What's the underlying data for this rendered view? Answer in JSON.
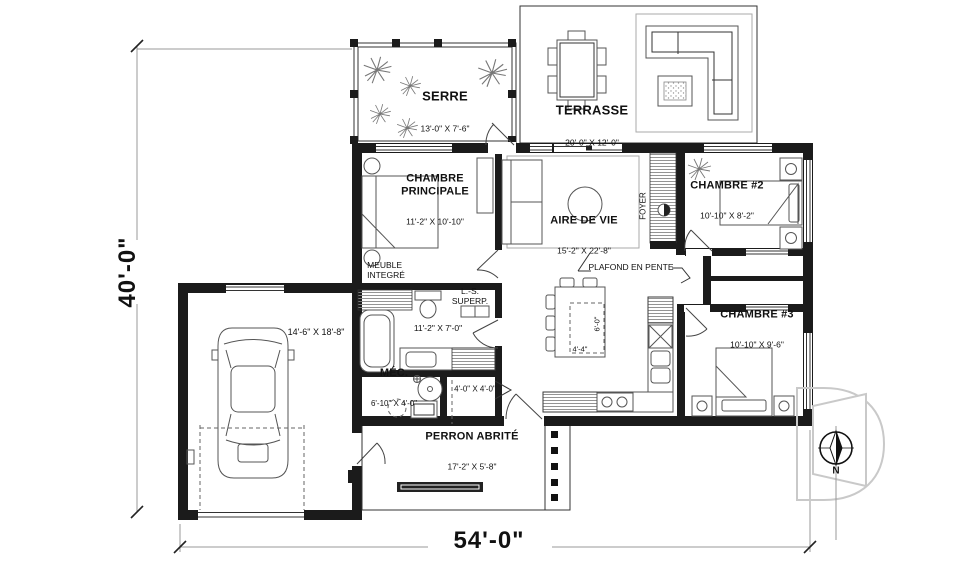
{
  "colors": {
    "walls": "#1b1b1b",
    "lines": "#555555",
    "dim": "#999999",
    "watermark": "#c9c9c9"
  },
  "dimensions": {
    "overall_width": "54'-0\"",
    "overall_height": "40'-0\""
  },
  "rooms": {
    "serre": {
      "name": "SERRE",
      "dims": "13'-0\" X 7'-6\""
    },
    "terrasse": {
      "name": "TERRASSE",
      "dims": "20'-0\" X 12'-0\""
    },
    "chambre_principale": {
      "name": "CHAMBRE\nPRINCIPALE",
      "dims": "11'-2\" X 10'-10\""
    },
    "aire_de_vie": {
      "name": "AIRE DE VIE",
      "dims": "15'-2\" X 22'-8\""
    },
    "chambre2": {
      "name": "CHAMBRE #2",
      "dims": "10'-10\" X 8'-2\""
    },
    "chambre3": {
      "name": "CHAMBRE #3",
      "dims": "10'-10\" X 9'-6\""
    },
    "mecanique": {
      "name": "MÉC.",
      "dims": "6'-10\" X 4'-0\""
    },
    "perron": {
      "name": "PERRON ABRITÉ",
      "dims": "17'-2\" X 5'-8\""
    },
    "garage": {
      "dims": "14'-6\" X 18'-8\""
    },
    "salle_de_bain": {
      "dims": "11'-2\" X 7'-0\""
    },
    "garde_robe_entree": {
      "dims": "4'-0\" X 4'-0\""
    }
  },
  "annotations": {
    "foyer": "FOYER",
    "plafond_en_pente": "PLAFOND EN PENTE",
    "meuble_integre": "MEUBLE\nINTEGRÉ",
    "laveuse_secheuse": "L.-S.\nSUPERP.",
    "ilot_depth": "6'-0\"",
    "ilot_width": "4'-4\"",
    "north": "N"
  }
}
